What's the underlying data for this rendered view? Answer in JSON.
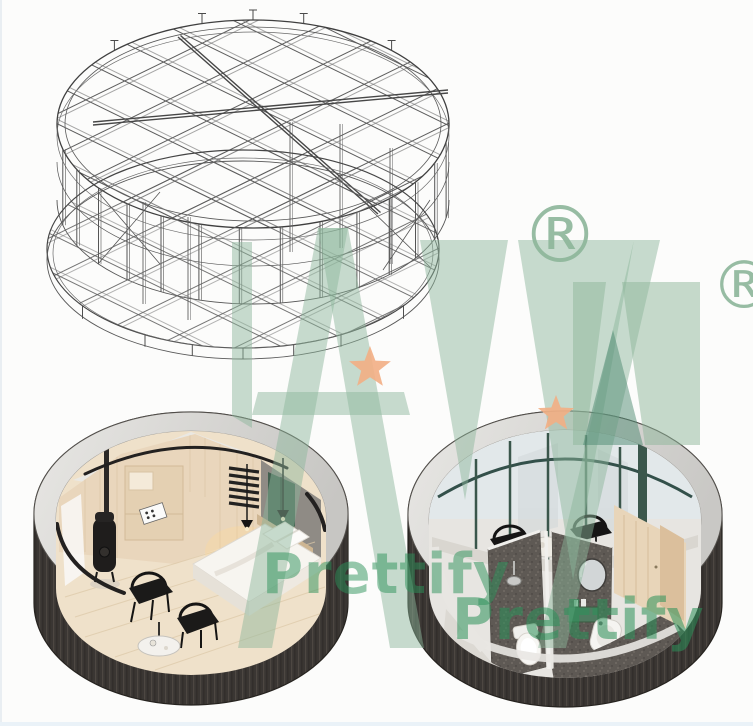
{
  "page": {
    "background_color": "#fcfcfb",
    "edge_tint_color": "#eaf2f8"
  },
  "watermark": {
    "brand_text": "Prettify",
    "registered_mark": "®",
    "logo_green": "#8db69a",
    "logo_dark_green": "#4e8a71",
    "star_orange": "#f2ae84",
    "text_green": "#2c925a"
  },
  "figures": {
    "frame_drawing": {
      "label": "circular steel frame structure — isometric wireframe",
      "line_color": "#565656"
    },
    "bedroom_pod": {
      "label": "capsule pod cutaway — bedroom interior",
      "shell_color": "#3a3633",
      "rim_color": "#d8d6d3"
    },
    "bathroom_pod": {
      "label": "capsule pod cutaway — bathroom interior",
      "shell_color": "#3a3633",
      "rim_color": "#d8d6d3"
    }
  }
}
